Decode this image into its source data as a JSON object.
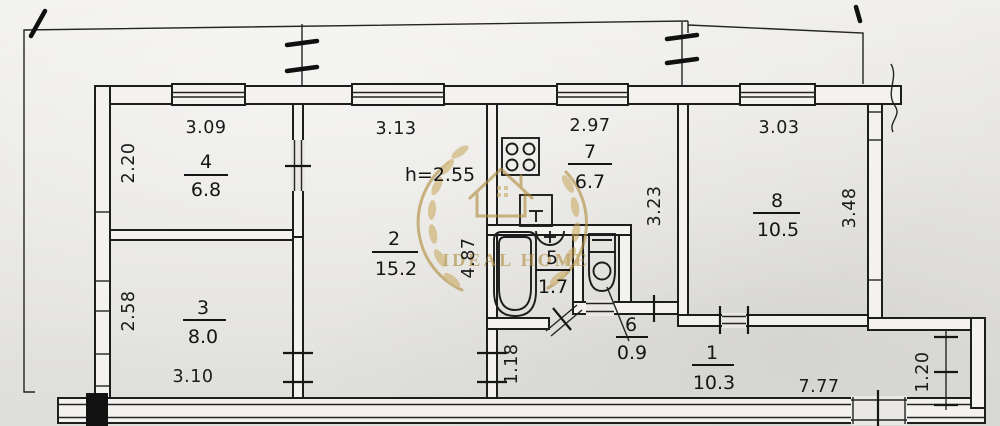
{
  "plan": {
    "ceiling_height_label": "h=2.55",
    "watermark_text": "IDEAL HOME",
    "watermark_color": "#b08d3e",
    "rooms": [
      {
        "id": "1",
        "number": "1",
        "area": "10.3"
      },
      {
        "id": "2",
        "number": "2",
        "area": "15.2"
      },
      {
        "id": "3",
        "number": "3",
        "area": "8.0"
      },
      {
        "id": "4",
        "number": "4",
        "area": "6.8"
      },
      {
        "id": "5",
        "number": "5",
        "area": "1.7"
      },
      {
        "id": "6",
        "number": "6",
        "area": "0.9"
      },
      {
        "id": "7",
        "number": "7",
        "area": "6.7"
      },
      {
        "id": "8",
        "number": "8",
        "area": "10.5"
      }
    ],
    "dimensions": {
      "room4_width": "3.09",
      "room4_depth": "2.20",
      "room2_width": "3.13",
      "room2_depth": "4.87",
      "room7_width": "2.97",
      "room7_depth": "3.23",
      "room8_width": "3.03",
      "room8_depth": "3.48",
      "room3_depth": "2.58",
      "room3_width": "3.10",
      "hall_height": "1.18",
      "hall_length": "7.77",
      "vestibule_depth": "1.20"
    }
  }
}
